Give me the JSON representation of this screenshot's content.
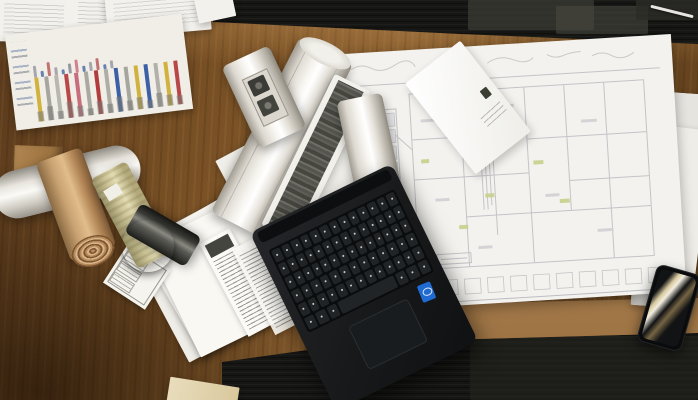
{
  "scene": {
    "setting": "overhead photograph of a wooden architect desk on dark carpet tiles",
    "objects": [
      "bar-chart printout",
      "paper stacks",
      "rolled blueprints",
      "kraft paper roll",
      "khaki drawing roll",
      "dark spiral roll",
      "white drawing tube",
      "envelope",
      "large architectural floor plan",
      "specification sheets",
      "form card",
      "black laptop with keyboard and touchpad",
      "blue processor sticker",
      "smartphone with light reflections",
      "white pen on carpet",
      "cardboard box corner"
    ]
  },
  "palette": {
    "carpet": "#161614",
    "carpet_patch_light": "#45453f",
    "carpet_patch_mid": "#30302b",
    "wood_mid": "#7a5226",
    "wood_edge_tan": "#b08a58",
    "paper": "#f3f1ec",
    "paper_dim": "#e7e5df",
    "plan_line": "#bcbcc0",
    "plan_highlight": "#c8d18c",
    "laptop_body": "#1a1c1e",
    "laptop_key": "#212427",
    "sticker_blue": "#1f6bd2",
    "phone_reflection": "#eedeaf",
    "kraft_tan": "#c9a272",
    "khaki_roll": "#cfc79a",
    "dark_roll": "#2e2e2a"
  },
  "chart_paper": {
    "stripe_colors": [
      "#d2b23e",
      "#a6a59e",
      "#b7b6af",
      "#b84747",
      "#c76d7c",
      "#a9a8a1",
      "#b23c3c",
      "#aeada6",
      "#3c5fa5",
      "#a6a59e",
      "#d2b23e",
      "#3c5fa5",
      "#b1b0a9",
      "#d2b23e",
      "#b84747"
    ],
    "base_bar_heights": [
      10,
      14,
      8,
      16,
      11,
      7,
      13,
      9,
      15,
      10,
      12,
      8,
      14,
      11,
      9
    ],
    "upper_mark_colors": [
      "#9a99a4",
      "#4f6fa8",
      "#b85c5c",
      "#9a99a4",
      "#4f6fa8",
      "#8a8994",
      "#c96f7e",
      "#4f6fa8",
      "#9a99a4",
      "#b85c5c",
      "#4f6fa8",
      "#9a99a4"
    ],
    "upper_mark_heights": [
      12,
      6,
      14,
      8,
      5,
      10,
      13,
      6,
      9,
      12,
      5,
      8
    ]
  },
  "laptop": {
    "keyboard_rows": [
      13,
      14,
      14,
      13,
      13
    ],
    "space_row_keys": 7,
    "sticker_color": "#1f6bd2"
  },
  "plan_sheet": {
    "title_rows": 9,
    "elevation_boxes": 13
  }
}
